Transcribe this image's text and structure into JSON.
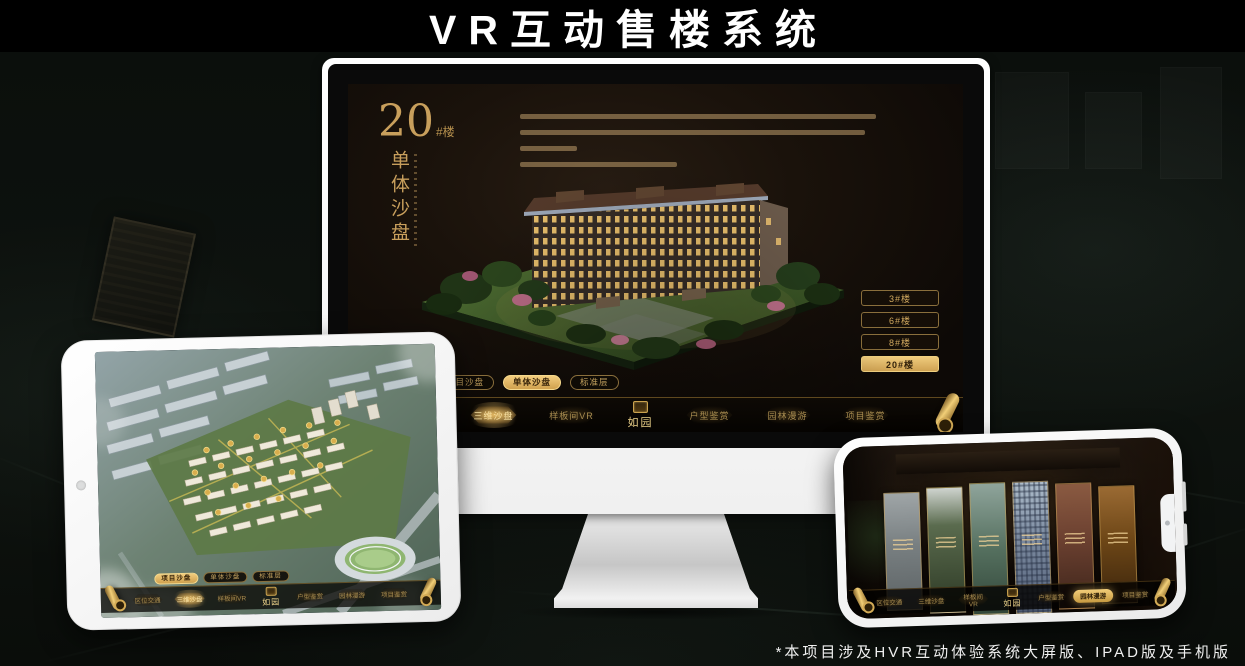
{
  "page": {
    "title": "VR互动售楼系统",
    "footnote": "*本项目涉及HVR互动体验系统大屏版、IPAD版及手机版"
  },
  "brand": {
    "logo": "如园"
  },
  "nav": {
    "items": [
      "区位交通",
      "三维沙盘",
      "样板间VR",
      "户型鉴赏",
      "园林漫游",
      "项目鉴赏"
    ]
  },
  "tabs": {
    "items": [
      "项目沙盘",
      "单体沙盘",
      "标准层"
    ]
  },
  "monitor_screen": {
    "building_no": "20",
    "building_unit": "#楼",
    "subtitle": "单体沙盘",
    "floor_buttons": [
      "3#楼",
      "6#楼",
      "8#楼",
      "20#楼"
    ],
    "active_floor": "20#楼",
    "active_tab": "单体沙盘",
    "active_nav": "三维沙盘"
  },
  "ipad_screen": {
    "active_tab": "项目沙盘",
    "active_nav": "三维沙盘"
  },
  "phone_screen": {
    "active_nav": "园林漫游"
  },
  "colors": {
    "gold": "#c9a35e",
    "gold_bright": "#f0cb79",
    "screen_bg": "#1a120b",
    "bar_bg": "#070402"
  }
}
